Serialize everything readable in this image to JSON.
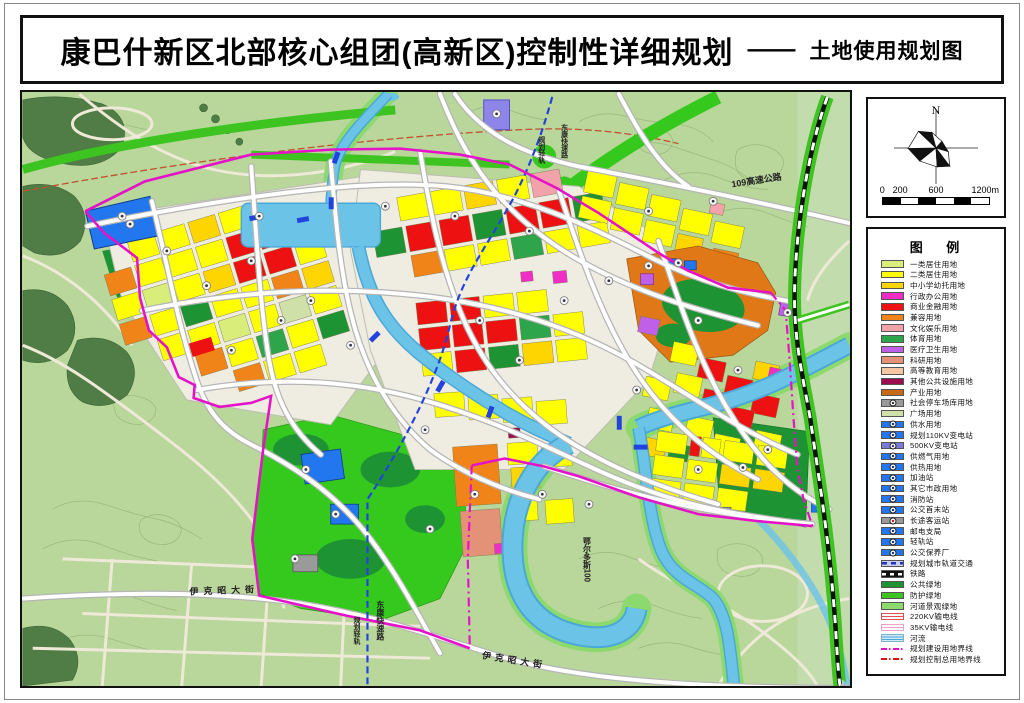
{
  "title": {
    "main": "康巴什新区北部核心组团(高新区)控制性详细规划",
    "dash": "——",
    "sub": "土地使用规划图"
  },
  "compass": {
    "north": "N",
    "scale_labels": [
      "0",
      "200",
      "600",
      "1200m"
    ]
  },
  "legend": {
    "title": "图 例",
    "items": [
      {
        "label": "一类居住用地",
        "sw": "solid",
        "c": "#d9ee7a"
      },
      {
        "label": "二类居住用地",
        "sw": "solid",
        "c": "#ffff00"
      },
      {
        "label": "中小学幼托用地",
        "sw": "solid",
        "c": "#ffd500"
      },
      {
        "label": "行政办公用地",
        "sw": "solid",
        "c": "#f12dc8"
      },
      {
        "label": "商业金融用地",
        "sw": "solid",
        "c": "#ee1111"
      },
      {
        "label": "兼容用地",
        "sw": "solid",
        "c": "#f08419"
      },
      {
        "label": "文化娱乐用地",
        "sw": "solid",
        "c": "#f2a2aa"
      },
      {
        "label": "体育用地",
        "sw": "solid",
        "c": "#2fa54b"
      },
      {
        "label": "医疗卫生用地",
        "sw": "solid",
        "c": "#c05fe8"
      },
      {
        "label": "科研用地",
        "sw": "solid",
        "c": "#e39177"
      },
      {
        "label": "高等教育用地",
        "sw": "solid",
        "c": "#f6c6a2"
      },
      {
        "label": "其他公共设施用地",
        "sw": "solid",
        "c": "#9b0d4e"
      },
      {
        "label": "产业用地",
        "sw": "solid",
        "c": "#c76a16"
      },
      {
        "label": "社会停车场库用地",
        "sw": "icon",
        "c": "#9a9a9a",
        "c2": "#3a3a3a"
      },
      {
        "label": "广场用地",
        "sw": "solid",
        "c": "#cfe0a8"
      },
      {
        "label": "供水用地",
        "sw": "icon",
        "c": "#2277ee",
        "c2": "#123a8c"
      },
      {
        "label": "规划110KV变电站",
        "sw": "icon",
        "c": "#2277ee",
        "c2": "#123a8c"
      },
      {
        "label": "500KV变电站",
        "sw": "icon",
        "c": "#7b7bd8",
        "c2": "#3a3a9c"
      },
      {
        "label": "供燃气用地",
        "sw": "icon",
        "c": "#2277ee",
        "c2": "#123a8c"
      },
      {
        "label": "供热用地",
        "sw": "icon",
        "c": "#2277ee",
        "c2": "#123a8c"
      },
      {
        "label": "加油站",
        "sw": "icon",
        "c": "#2277ee",
        "c2": "#123a8c"
      },
      {
        "label": "其它市政用地",
        "sw": "icon",
        "c": "#2277ee",
        "c2": "#123a8c"
      },
      {
        "label": "消防站",
        "sw": "icon",
        "c": "#2277ee",
        "c2": "#123a8c"
      },
      {
        "label": "公交首末站",
        "sw": "icon",
        "c": "#2277ee",
        "c2": "#123a8c"
      },
      {
        "label": "长途客运站",
        "sw": "icon",
        "c": "#9a9a9a",
        "c2": "#cc2222"
      },
      {
        "label": "邮电支局",
        "sw": "icon",
        "c": "#2277ee",
        "c2": "#123a8c"
      },
      {
        "label": "轻轨站",
        "sw": "icon",
        "c": "#2277ee",
        "c2": "#123a8c"
      },
      {
        "label": "公交保养厂",
        "sw": "icon",
        "c": "#2277ee",
        "c2": "#123a8c"
      },
      {
        "label": "规划城市轨道交通",
        "sw": "metro",
        "c": "#c9cdf0",
        "c2": "#2233bb"
      },
      {
        "label": "铁路",
        "sw": "rail",
        "c": "#111111",
        "c2": "#ffffff"
      },
      {
        "label": "公共绿地",
        "sw": "solid",
        "c": "#1d9334"
      },
      {
        "label": "防护绿地",
        "sw": "solid",
        "c": "#3ec421"
      },
      {
        "label": "河道景观绿地",
        "sw": "solid",
        "c": "#8cd96e"
      },
      {
        "label": "220KV输电线",
        "sw": "power",
        "c": "#e05050"
      },
      {
        "label": "35KV输电线",
        "sw": "power",
        "c": "#f0a0c8"
      },
      {
        "label": "河流",
        "sw": "river",
        "c": "#cfe9f5",
        "c2": "#4aa8d8"
      },
      {
        "label": "规划建设用地界线",
        "sw": "dash",
        "c": "#e513c8"
      },
      {
        "label": "规划控制总用地界线",
        "sw": "dash",
        "c": "#e01010"
      }
    ]
  },
  "map": {
    "labels": [
      {
        "t": "109高速公路",
        "x": 714,
        "y": 96,
        "r": -9,
        "fs": 9
      },
      {
        "t": "伊克昭大街",
        "x": 168,
        "y": 506,
        "r": -2,
        "fs": 9,
        "ls": 5
      },
      {
        "t": "伊克昭大街",
        "x": 462,
        "y": 570,
        "r": 9,
        "fs": 9,
        "ls": 4
      },
      {
        "t": "东康快速路",
        "x": 360,
        "y": 512,
        "v": 1,
        "fs": 8
      },
      {
        "t": "规划轻轨",
        "x": 336,
        "y": 528,
        "v": 1,
        "fs": 7
      },
      {
        "t": "鄂尔多斯100",
        "x": 568,
        "y": 448,
        "v": 1,
        "fs": 8
      },
      {
        "t": "东康快速路",
        "x": 545,
        "y": 32,
        "v": 1,
        "fs": 7
      },
      {
        "t": "规划轻轨",
        "x": 522,
        "y": 44,
        "v": 1,
        "fs": 7
      }
    ],
    "badges": [
      [
        100,
        125
      ],
      [
        145,
        160
      ],
      [
        185,
        195
      ],
      [
        230,
        170
      ],
      [
        260,
        230
      ],
      [
        210,
        260
      ],
      [
        290,
        210
      ],
      [
        365,
        115
      ],
      [
        435,
        125
      ],
      [
        510,
        140
      ],
      [
        460,
        230
      ],
      [
        500,
        270
      ],
      [
        545,
        210
      ],
      [
        590,
        190
      ],
      [
        630,
        175
      ],
      [
        660,
        172
      ],
      [
        680,
        230
      ],
      [
        720,
        280
      ],
      [
        750,
        360
      ],
      [
        680,
        380
      ],
      [
        725,
        378
      ],
      [
        570,
        415
      ],
      [
        455,
        405
      ],
      [
        410,
        440
      ],
      [
        285,
        380
      ],
      [
        315,
        425
      ],
      [
        274,
        470
      ],
      [
        630,
        120
      ],
      [
        695,
        110
      ],
      [
        108,
        133
      ],
      [
        477,
        22
      ],
      [
        238,
        125
      ],
      [
        330,
        255
      ],
      [
        405,
        340
      ],
      [
        523,
        405
      ],
      [
        618,
        300
      ],
      [
        770,
        222
      ]
    ]
  }
}
